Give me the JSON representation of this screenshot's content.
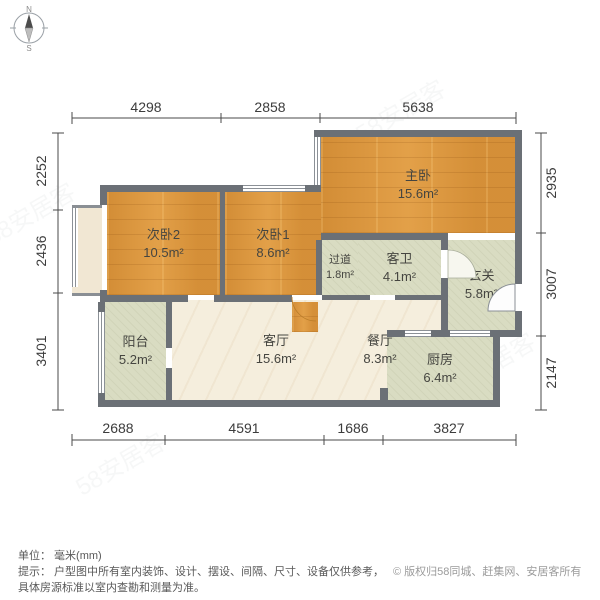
{
  "compass": {
    "north": "N",
    "south": "S"
  },
  "dimensions": {
    "top": [
      "4298",
      "2858",
      "5638"
    ],
    "bottom": [
      "2688",
      "4591",
      "1686",
      "3827"
    ],
    "left": [
      "2252",
      "2436",
      "3401"
    ],
    "right": [
      "2935",
      "3007",
      "2147"
    ]
  },
  "rooms": [
    {
      "id": "master-bedroom",
      "name": "主卧",
      "area": "15.6m²"
    },
    {
      "id": "bedroom-2",
      "name": "次卧2",
      "area": "10.5m²"
    },
    {
      "id": "bedroom-1",
      "name": "次卧1",
      "area": "8.6m²"
    },
    {
      "id": "hallway",
      "name": "过道",
      "area": "1.8m²"
    },
    {
      "id": "guest-bathroom",
      "name": "客卫",
      "area": "4.1m²"
    },
    {
      "id": "entry-foyer",
      "name": "玄关",
      "area": "5.8m²"
    },
    {
      "id": "balcony",
      "name": "阳台",
      "area": "5.2m²"
    },
    {
      "id": "living-room",
      "name": "客厅",
      "area": "15.6m²"
    },
    {
      "id": "dining-room",
      "name": "餐厅",
      "area": "8.3m²"
    },
    {
      "id": "kitchen",
      "name": "厨房",
      "area": "6.4m²"
    }
  ],
  "footer": {
    "unit_line": "单位： 毫米(mm)",
    "tip_line1": "提示： 户型图中所有室内装饰、设计、摆设、间隔、尺寸、设备仅供参考，",
    "tip_line2": "具体房源标准以室内查勘和测量为准。",
    "copyright": "© 版权归58同城、赶集网、安居客所有"
  },
  "watermark": {
    "text": "58安居客"
  },
  "colors": {
    "wall": "#6b7076",
    "wood_floor": "#de9940",
    "sage_floor": "#d9dcc2",
    "beige_floor": "#f5eedd",
    "bay_window": "#f1e7d3",
    "dimension_text": "#3c3c3c",
    "note_text": "#595959",
    "copyright_text": "#9b9b9b"
  }
}
